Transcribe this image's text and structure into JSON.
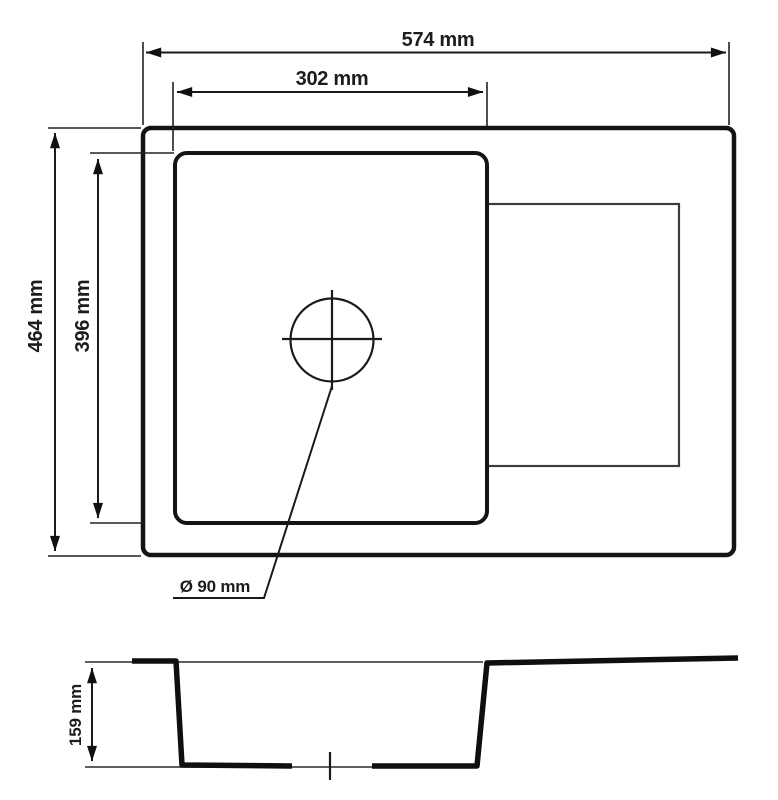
{
  "labels": {
    "overall_width": "574 mm",
    "bowl_width": "302 mm",
    "overall_depth": "464 mm",
    "bowl_depth": "396 mm",
    "drain_diameter": "Ø 90 mm",
    "bowl_height": "159 mm"
  },
  "colors": {
    "line": "#141414",
    "drainboard_line": "#3c3c3c",
    "dimension_line": "#1a1a1a",
    "background": "#ffffff"
  }
}
